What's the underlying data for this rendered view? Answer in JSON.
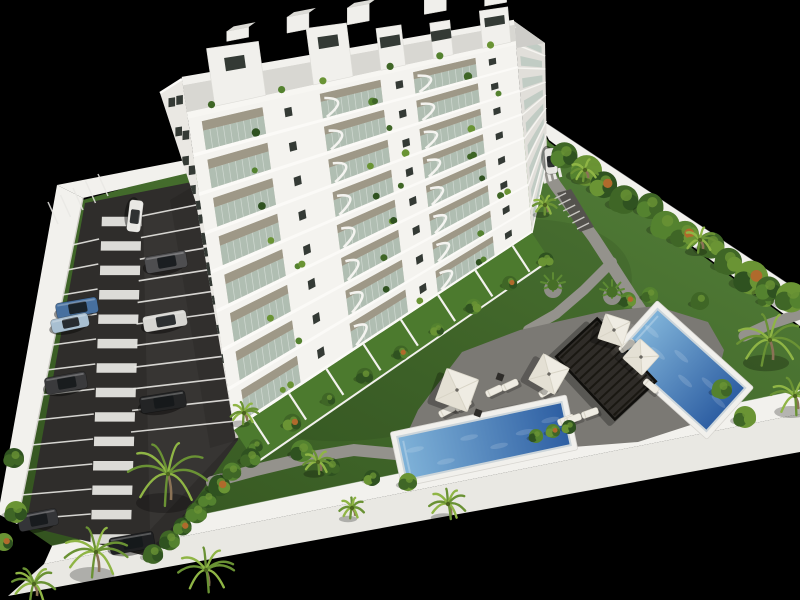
{
  "scene": {
    "description": "Aerial 3D architectural render of a white apartment building with landscaped gardens, a parking lot with cars, two blue swimming pools, a dark pergola with sun loungers and parasols, all enclosed by white perimeter walls on a black background",
    "background_color": "#000000",
    "canvas_width": 800,
    "canvas_height": 600
  },
  "colors": {
    "background": "#000000",
    "grass_light": "#55803a",
    "grass": "#41682a",
    "grass_dark": "#33521f",
    "asphalt": "#2f2d2b",
    "asphalt_light": "#3d3b38",
    "marking": "#e9e8e4",
    "wall": "#e9e8e3",
    "wall_bright": "#f2f1ed",
    "wall_shade": "#cfcdc7",
    "deck": "#7b7974",
    "deck_dark": "#615f5b",
    "path": "#94928c",
    "facade": "#f4f3ef",
    "facade_shade": "#eae8e3",
    "facade_side": "#e1dfda",
    "roof": "#cecdc9",
    "window": "#343a35",
    "glass": "#a7bcb2",
    "recess": "#c7c0b2",
    "recess_shadow": "#97917f",
    "pool_border": "#f1f0ec",
    "water_light": "#7fb2d8",
    "water_deep": "#2e5fa3",
    "pergola": "#2b2824",
    "furniture": "#efece3",
    "foliage_dark": "#2f5220",
    "foliage": "#3f6626",
    "foliage_mid": "#54822f",
    "foliage_light": "#6a9434",
    "palm_leaf": "#8fb545",
    "trunk": "#8a7256",
    "flower": "#b06a2c",
    "terrace_green": "#4c7a2e"
  },
  "building": {
    "floors": 9,
    "balcony_bays": 3,
    "penthouse_volumes": 5,
    "roof_bulkheads": 5,
    "terrace_walls": 8
  },
  "parking": {
    "zebra_stripes": 14,
    "left_stalls": 12,
    "right_stalls": 11,
    "hatch_lines": 5,
    "cars": [
      {
        "name": "white-hatchback",
        "color": "#e9e8e4",
        "x": 135,
        "y": 216,
        "len": 32,
        "wid": 14,
        "angle": 97
      },
      {
        "name": "gray-suv",
        "color": "#4e4e50",
        "x": 166,
        "y": 262,
        "len": 42,
        "wid": 17,
        "angle": -10
      },
      {
        "name": "blue-sedan",
        "color": "#47709f",
        "x": 77,
        "y": 308,
        "len": 42,
        "wid": 16,
        "angle": -10
      },
      {
        "name": "lightblue-car",
        "color": "#a8bfd1",
        "x": 70,
        "y": 323,
        "len": 38,
        "wid": 14,
        "angle": -12
      },
      {
        "name": "silver-sedan",
        "color": "#d7d6d2",
        "x": 165,
        "y": 321,
        "len": 44,
        "wid": 16,
        "angle": -10
      },
      {
        "name": "dark-suv",
        "color": "#3a3a3c",
        "x": 66,
        "y": 383,
        "len": 42,
        "wid": 17,
        "angle": -10
      },
      {
        "name": "black-sedan",
        "color": "#232425",
        "x": 163,
        "y": 402,
        "len": 46,
        "wid": 17,
        "angle": -9
      },
      {
        "name": "dark-suv-2",
        "color": "#343538",
        "x": 38,
        "y": 520,
        "len": 40,
        "wid": 17,
        "angle": -11
      },
      {
        "name": "black-sedan-2",
        "color": "#1f2022",
        "x": 132,
        "y": 543,
        "len": 45,
        "wid": 17,
        "angle": -10
      },
      {
        "name": "white-car-drive",
        "color": "#e7e6e2",
        "x": 551,
        "y": 161,
        "len": 26,
        "wid": 12,
        "angle": 85
      }
    ]
  },
  "pools": [
    {
      "name": "lap-pool",
      "x": 484,
      "y": 441,
      "length": 166,
      "width": 42,
      "angle": -12
    },
    {
      "name": "plunge-pool",
      "x": 682,
      "y": 370,
      "length": 116,
      "width": 56,
      "angle": 42
    }
  ],
  "amenities": {
    "pergola": {
      "x": 606,
      "y": 369,
      "length": 86,
      "width": 56,
      "angle": 47,
      "slats": 12
    },
    "umbrellas": [
      {
        "x": 457,
        "y": 390,
        "size": 34,
        "angle": 20
      },
      {
        "x": 549,
        "y": 374,
        "size": 30,
        "angle": 30
      },
      {
        "x": 614,
        "y": 330,
        "size": 26,
        "angle": 18
      },
      {
        "x": 641,
        "y": 357,
        "size": 26,
        "angle": 42
      }
    ],
    "loungers": [
      [
        447,
        411,
        -28
      ],
      [
        463,
        405,
        -28
      ],
      [
        494,
        391,
        -25
      ],
      [
        510,
        385,
        -25
      ],
      [
        547,
        391,
        -30
      ],
      [
        566,
        420,
        -22
      ],
      [
        573,
        419,
        -20
      ],
      [
        590,
        413,
        -20
      ],
      [
        627,
        346,
        -35
      ],
      [
        651,
        386,
        40
      ]
    ],
    "side_tables": [
      [
        500,
        377
      ],
      [
        478,
        413
      ]
    ]
  },
  "landscape": {
    "palms": [
      [
        168,
        474,
        40,
        26
      ],
      [
        96,
        552,
        32,
        20
      ],
      [
        206,
        570,
        28,
        16
      ],
      [
        34,
        584,
        22,
        12
      ],
      [
        318,
        462,
        15,
        9
      ],
      [
        352,
        508,
        13,
        8
      ],
      [
        448,
        504,
        19,
        11
      ],
      [
        545,
        205,
        12,
        7
      ],
      [
        770,
        340,
        33,
        20
      ],
      [
        795,
        396,
        24,
        13
      ],
      [
        244,
        413,
        14,
        8
      ],
      [
        585,
        170,
        14,
        8
      ],
      [
        700,
        240,
        16,
        9
      ]
    ],
    "hedge_count": 8,
    "terrace_bush_count": 9,
    "wall_tree_count": 12,
    "lawn_bushes": [
      [
        302,
        451,
        11
      ],
      [
        331,
        467,
        9
      ],
      [
        536,
        436,
        7
      ],
      [
        553,
        431,
        7
      ],
      [
        569,
        427,
        7
      ],
      [
        700,
        301,
        9
      ],
      [
        722,
        389,
        10
      ],
      [
        745,
        417,
        11
      ],
      [
        628,
        300,
        8
      ],
      [
        650,
        295,
        8
      ],
      [
        766,
        299,
        8
      ],
      [
        14,
        458,
        10
      ],
      [
        16,
        512,
        11
      ],
      [
        4,
        542,
        9
      ],
      [
        372,
        478,
        8
      ],
      [
        408,
        482,
        9
      ]
    ],
    "planters": [
      [
        553,
        285
      ],
      [
        612,
        292
      ]
    ]
  }
}
